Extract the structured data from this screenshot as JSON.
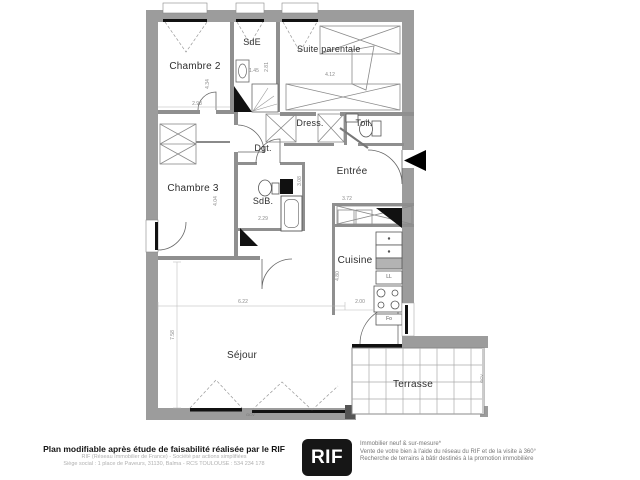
{
  "plan": {
    "rooms": {
      "chambre2": "Chambre 2",
      "sde": "SdE",
      "suite_parentale": "Suite parentale",
      "dress": "Dress.",
      "toil": "Toil.",
      "dgt": "Dgt.",
      "entree": "Entrée",
      "chambre3": "Chambre 3",
      "sdb": "SdB.",
      "cuisine": "Cuisine",
      "sejour": "Séjour",
      "terrasse": "Terrasse"
    },
    "dims": {
      "chambre2_width": "2.98",
      "chambre2_height": "4.34",
      "sde_width": "1.45",
      "sde_height": "2.81",
      "suite_width": "4.12",
      "sdb_height": "3.08",
      "sdb_width": "2.29",
      "chambre3_height": "4.04",
      "closet_width": "3.72",
      "cuisine_height": "4.80",
      "cuisine_width": "2.00",
      "sejour_width": "6.22",
      "sejour_height": "7.58"
    },
    "appliances": {
      "washing_machine": "LL",
      "oven": "Fo"
    },
    "window_code": "GCV",
    "colors": {
      "wall": "#9c9c9c",
      "line": "#4a4a4a",
      "fixture_black": "#111111",
      "background": "#ffffff"
    }
  },
  "footer": {
    "disclaimer_bold": "Plan modifiable après étude de faisabilité réalisée par le RIF",
    "company_line1": "RIF (Réseau Immobilier de France) - Société par actions simplifiées",
    "company_line2": "Siège social : 1 place de Paveurs, 31130, Balma - RCS TOULOUSE : 534 234 178",
    "logo_text": "RIF",
    "services": [
      "Immobilier neuf & sur-mesure*",
      "Vente de votre bien à l'aide du réseau du RIF et de la visite à 360°",
      "Recherche de terrains à bâtir destinés à la promotion immobilière"
    ]
  }
}
